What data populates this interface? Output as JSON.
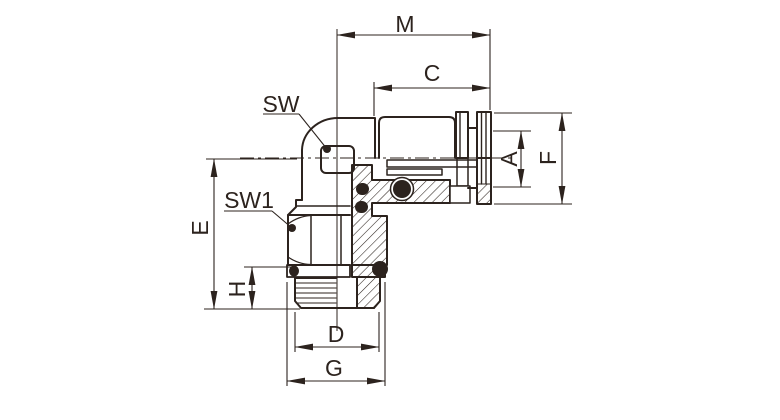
{
  "drawing": {
    "background_color": "#ffffff",
    "line_color": "#2c231e",
    "dimension_labels": {
      "m": "M",
      "c": "C",
      "a": "A",
      "f": "F",
      "e": "E",
      "h": "H",
      "d": "D",
      "g": "G"
    },
    "callouts": {
      "sw": "SW",
      "sw1": "SW1"
    }
  }
}
